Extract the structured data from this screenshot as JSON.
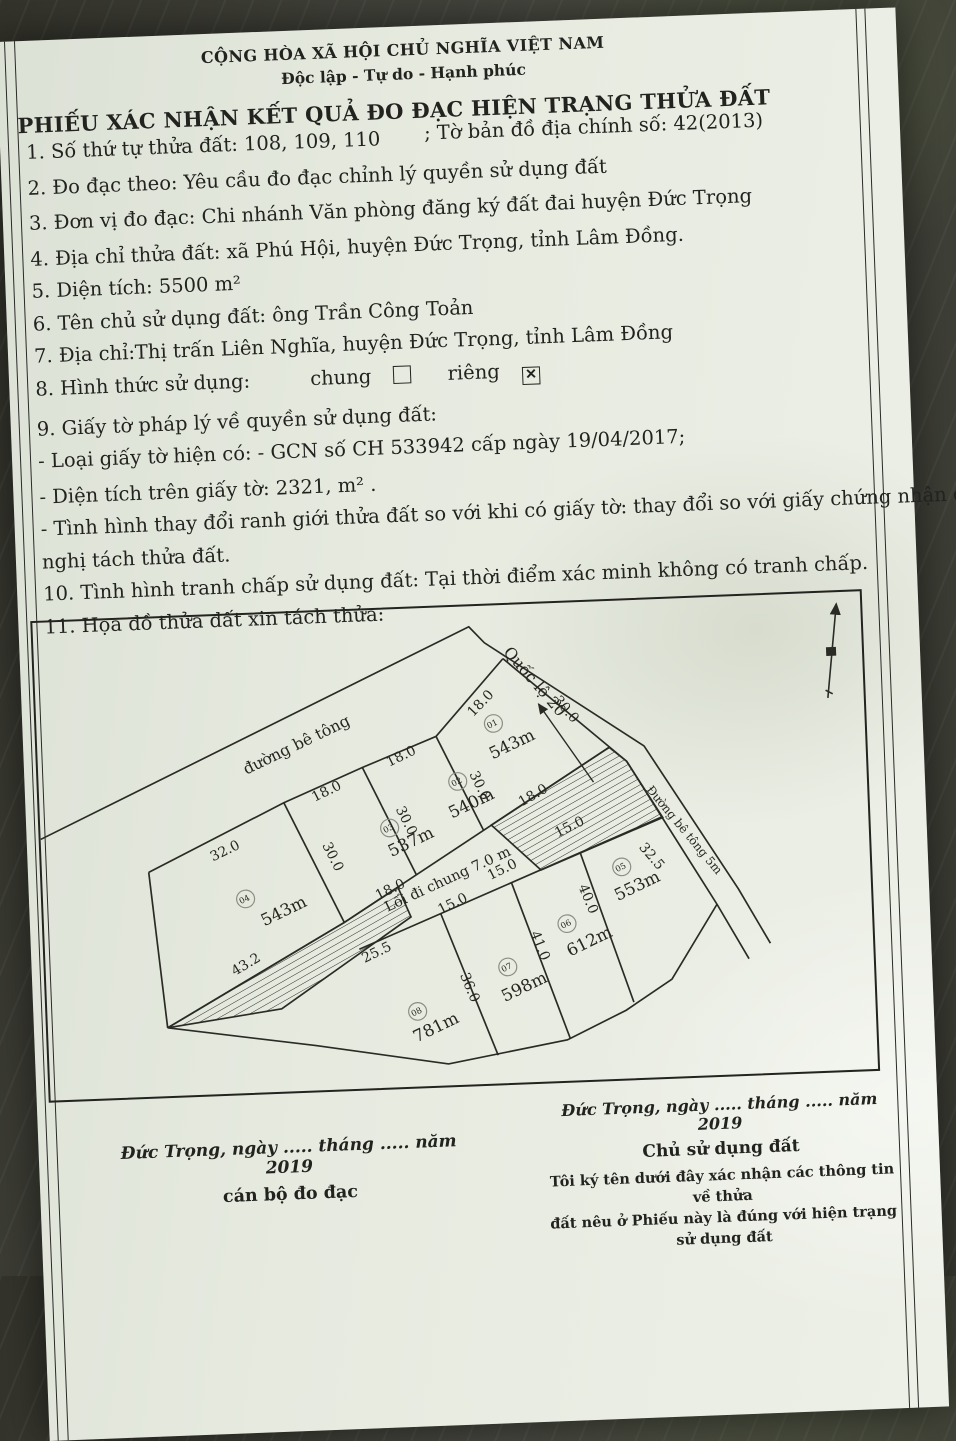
{
  "header": {
    "national_title": "CỘNG HÒA XÃ HỘI CHỦ NGHĨA VIỆT NAM",
    "national_motto": "Độc lập - Tự do - Hạnh phúc",
    "form_title": "PHIẾU XÁC NHẬN KẾT QUẢ ĐO ĐẠC HIỆN TRẠNG THỬA ĐẤT"
  },
  "items": {
    "item1": "1. Số thứ tự thửa đất: 108, 109, 110",
    "item1_suffix": "; Tờ bản đồ địa chính số: 42(2013)",
    "item2": "2. Đo đạc theo: Yêu cầu đo đạc chỉnh lý quyền sử dụng đất",
    "item3": "3. Đơn vị đo đạc: Chi nhánh Văn phòng đăng ký đất đai huyện Đức Trọng",
    "item4": "4. Địa chỉ thửa đất: xã Phú Hội, huyện Đức Trọng, tỉnh Lâm Đồng.",
    "item5": "5. Diện tích: 5500 m²",
    "item6": "6. Tên chủ sử dụng đất: ông Trần Công Toản",
    "item7": "7. Địa chỉ:Thị trấn Liên Nghĩa, huyện Đức Trọng, tỉnh Lâm Đồng",
    "item8_label": "8. Hình thức sử dụng:",
    "item8_chung": "chung",
    "item8_rieng": "riêng",
    "checkbox_mark": "✕",
    "item9": "9. Giấy tờ pháp lý về quyền sử dụng đất:",
    "item9_sub1": "- Loại giấy tờ hiện có: - GCN số CH 533942 cấp ngày 19/04/2017;",
    "item9_sub2": "- Diện tích trên giấy tờ: 2321, m² .",
    "item9_sub3": "- Tình hình thay đổi ranh giới thửa đất so với khi có giấy tờ: thay đổi so với giấy chứng nhận do đề",
    "item9_sub3b": "nghị tách thửa đất.",
    "item10": "10. Tình hình tranh chấp sử dụng đất: Tại thời điểm xác minh không có tranh chấp.",
    "item11": "11. Họa đồ thửa đất xin tách thửa:"
  },
  "map": {
    "parcels": [
      {
        "no": "04",
        "area": "543m",
        "cx": 203,
        "cy": 291,
        "ax": 243,
        "ay": 310
      },
      {
        "no": "03",
        "area": "537m",
        "cx": 350,
        "cy": 224,
        "ax": 373,
        "ay": 244
      },
      {
        "no": "02",
        "area": "540m",
        "cx": 420,
        "cy": 179,
        "ax": 435,
        "ay": 207
      },
      {
        "no": "01",
        "area": "543m",
        "cx": 458,
        "cy": 121,
        "ax": 478,
        "ay": 148
      },
      {
        "no": "05",
        "area": "553m",
        "cx": 581,
        "cy": 273,
        "ax": 598,
        "ay": 298
      },
      {
        "no": "06",
        "area": "612m",
        "cx": 524,
        "cy": 329,
        "ax": 548,
        "ay": 353
      },
      {
        "no": "07",
        "area": "598m",
        "cx": 463,
        "cy": 371,
        "ax": 481,
        "ay": 397
      },
      {
        "no": "08",
        "area": "781m",
        "cx": 371,
        "cy": 413,
        "ax": 391,
        "ay": 435
      }
    ],
    "labels": [
      {
        "t": "đường bê tông",
        "x": 262,
        "y": 140,
        "r": -24,
        "s": 16,
        "n": "road-label-top"
      },
      {
        "t": "Quốc lộ 20",
        "x": 497,
        "y": 83,
        "r": 52,
        "s": 16,
        "n": "road-label-ql20"
      },
      {
        "t": "Đường bê tông 5m",
        "x": 642,
        "y": 240,
        "r": 53,
        "s": 12,
        "n": "road-label-side"
      },
      {
        "t": "Lối đi chung 7.0 m",
        "x": 408,
        "y": 283,
        "r": -23,
        "s": 14.5,
        "n": "common-path-label"
      },
      {
        "t": "32.0",
        "x": 186,
        "y": 245,
        "r": -24,
        "s": 14,
        "n": "dim"
      },
      {
        "t": "18.0",
        "x": 290,
        "y": 188,
        "r": -24,
        "s": 14,
        "n": "dim"
      },
      {
        "t": "18.0",
        "x": 366,
        "y": 155,
        "r": -24,
        "s": 14,
        "n": "dim"
      },
      {
        "t": "18.0",
        "x": 449,
        "y": 103,
        "r": -44,
        "s": 14,
        "n": "dim"
      },
      {
        "t": "30.0",
        "x": 288,
        "y": 253,
        "r": 66,
        "s": 14,
        "n": "dim"
      },
      {
        "t": "30.0",
        "x": 363,
        "y": 219,
        "r": 66,
        "s": 14,
        "n": "dim"
      },
      {
        "t": "30.0",
        "x": 438,
        "y": 186,
        "r": 66,
        "s": 14,
        "n": "dim"
      },
      {
        "t": "30.0",
        "x": 528,
        "y": 112,
        "r": 52,
        "s": 14,
        "n": "dim"
      },
      {
        "t": "43.2",
        "x": 203,
        "y": 362,
        "r": -29,
        "s": 14,
        "n": "dim"
      },
      {
        "t": "25.5",
        "x": 334,
        "y": 355,
        "r": -24,
        "s": 14,
        "n": "dim"
      },
      {
        "t": "18.0",
        "x": 350,
        "y": 291,
        "r": -24,
        "s": 14,
        "n": "dim"
      },
      {
        "t": "18.0",
        "x": 497,
        "y": 200,
        "r": -28,
        "s": 14,
        "n": "dim"
      },
      {
        "t": "15.0",
        "x": 412,
        "y": 308,
        "r": -24,
        "s": 14,
        "n": "dim"
      },
      {
        "t": "15.0",
        "x": 463,
        "y": 275,
        "r": -24,
        "s": 14,
        "n": "dim"
      },
      {
        "t": "15.0",
        "x": 532,
        "y": 234,
        "r": -24,
        "s": 14,
        "n": "dim"
      },
      {
        "t": "36.0",
        "x": 420,
        "y": 392,
        "r": 70,
        "s": 14,
        "n": "dim"
      },
      {
        "t": "41.0",
        "x": 492,
        "y": 352,
        "r": 70,
        "s": 14,
        "n": "dim"
      },
      {
        "t": "40.0",
        "x": 542,
        "y": 306,
        "r": 70,
        "s": 14,
        "n": "dim"
      },
      {
        "t": "32.5",
        "x": 608,
        "y": 266,
        "r": 52,
        "s": 14,
        "n": "dim"
      }
    ]
  },
  "signatures": {
    "left": {
      "date_line": "Đức Trọng, ngày ..... tháng ..... năm 2019",
      "role": "cán bộ đo đạc"
    },
    "right": {
      "date_line": "Đức Trọng, ngày ..... tháng ..... năm 2019",
      "role": "Chủ sử dụng đất",
      "note1": "Tôi ký tên dưới đây xác nhận các thông tin về thửa",
      "note2": "đất nêu ở Phiếu này là đúng với hiện trạng sử dụng đất"
    }
  }
}
